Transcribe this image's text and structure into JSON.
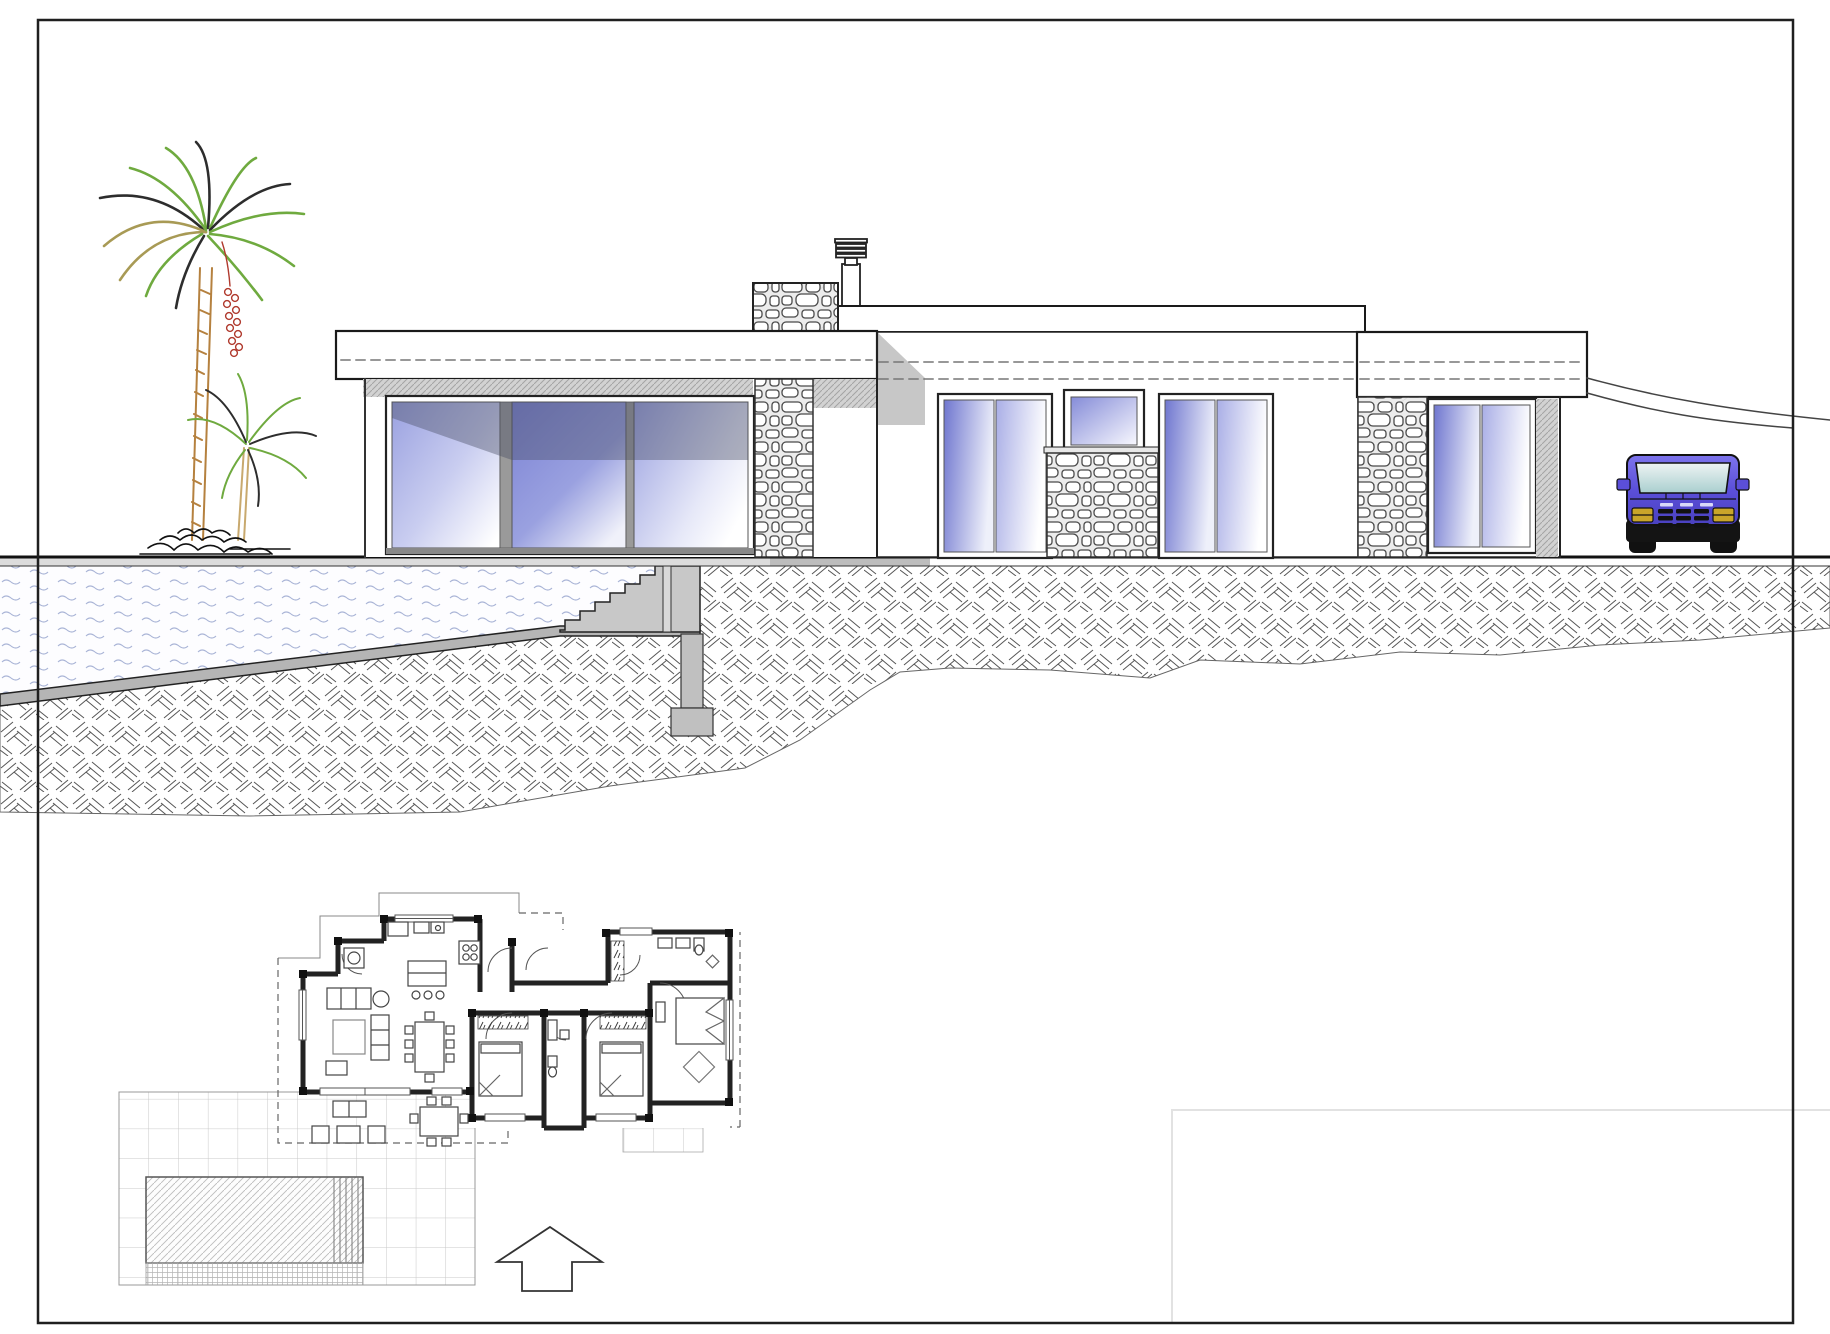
{
  "drawing": {
    "kind": "architectural plan and elevation sheet",
    "views": [
      "south elevation with terrain section",
      "ground floor plan with pool terrace"
    ],
    "visible_text": "",
    "elements": {
      "elevation": [
        "flat roof fascia with dashed shutter lines",
        "stone clad parapet",
        "chimney with fins",
        "sliding glass walls",
        "stone pillars",
        "small kitchen window",
        "terrain section with pool and stairs",
        "column footing",
        "palm trees",
        "parked suv"
      ],
      "plan": [
        "living room",
        "kitchen",
        "dining table",
        "three bedrooms",
        "bathroom",
        "wc",
        "terrace tile grid",
        "swimming pool with steps",
        "outdoor furniture",
        "north arrow"
      ]
    }
  },
  "colors": {
    "line": "#1f1f1f",
    "wall": "#ffffff",
    "stoneStroke": "#4a4a4a",
    "stoneBg": "#ececec",
    "earthStroke": "#555555",
    "waterStroke": "#a9b4d6",
    "shadowGray": "#c7c7c7",
    "hatchBase": "#d2d2d2",
    "glassDeep": "#7b82d4",
    "glassMid": "#9aa1e0",
    "glassPale": "#c9cdf0",
    "glassWhite": "#ffffff",
    "glassShadow": "rgba(70,76,98,0.40)",
    "trunk": "#b5813f",
    "trunkLight": "#c8a96e",
    "palmGreen": "#6faa3f",
    "palmDark": "#2d2d2d",
    "palmOlive": "#a89a55",
    "palmRed": "#b03a2e",
    "carBodyTop": "#7d74ec",
    "carBody": "#5b4fd9",
    "carBodyDeep": "#4a41c0",
    "carDark": "#141414",
    "carGlassTop": "#eef3f3",
    "carGlassBot": "#a9cfcf",
    "carLight": "#c9a52a",
    "tileLine": "#c9c9c9",
    "poolHatch": "#bdbdbd",
    "planWall": "#222222",
    "planThin": "#555555",
    "dashGray": "#777777"
  }
}
